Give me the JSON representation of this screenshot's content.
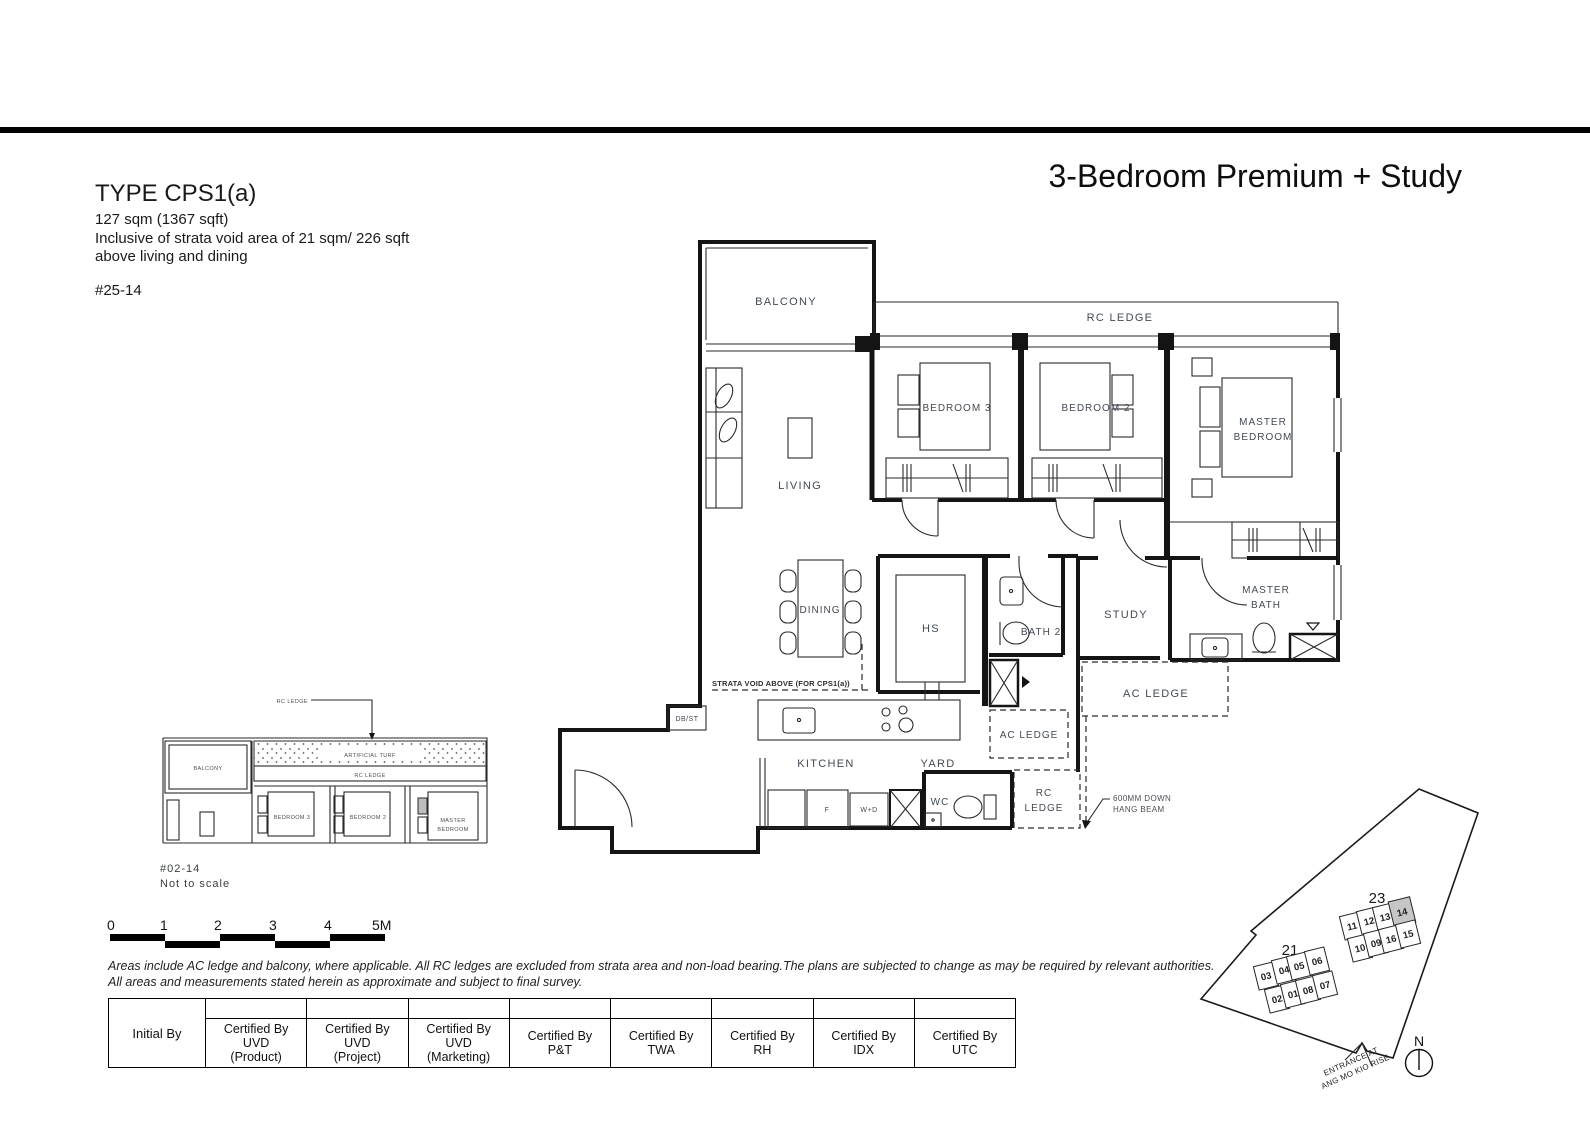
{
  "header": {
    "type_title": "TYPE CPS1(a)",
    "area": "127 sqm (1367 sqft)",
    "inclusive1": "Inclusive of strata void area of 21 sqm/ 226 sqft",
    "inclusive2": "above living and dining",
    "unit": "#25-14",
    "plan_name": "3-Bedroom Premium + Study"
  },
  "plan": {
    "balcony": "BALCONY",
    "living": "LIVING",
    "dining": "DINING",
    "bedroom3": "BEDROOM 3",
    "bedroom2": "BEDROOM 2",
    "master_bedroom_l1": "MASTER",
    "master_bedroom_l2": "BEDROOM",
    "rc_ledge_top": "RC LEDGE",
    "hs": "HS",
    "bath2": "BATH 2",
    "study": "STUDY",
    "master_bath_l1": "MASTER",
    "master_bath_l2": "BATH",
    "ac_ledge_right": "AC LEDGE",
    "ac_ledge_mid": "AC LEDGE",
    "kitchen": "KITCHEN",
    "yard": "YARD",
    "wc": "WC",
    "rc_ledge_bottom_l1": "RC",
    "rc_ledge_bottom_l2": "LEDGE",
    "db_st": "DB/ST",
    "strata_void": "STRATA VOID ABOVE (FOR CPS1(a))",
    "beam_l1": "600MM DOWN",
    "beam_l2": "HANG BEAM",
    "fridge": "F",
    "washer": "W+D"
  },
  "inset": {
    "rc_ledge_callout": "RC LEDGE",
    "artificial_turf": "ARTIFICIAL TURF",
    "rc_ledge": "RC LEDGE",
    "balcony": "BALCONY",
    "bedroom3": "BEDROOM 3",
    "bedroom2": "BEDROOM 2",
    "master_l1": "MASTER",
    "master_l2": "BEDROOM",
    "caption1": "#02-14",
    "caption2": "Not to scale"
  },
  "scalebar": {
    "ticks": [
      "0",
      "1",
      "2",
      "3",
      "4",
      "5M"
    ]
  },
  "disclaimer": {
    "line1": "Areas include AC ledge and balcony, where applicable. All RC ledges are excluded from strata area and non-load bearing.The plans are subjected to change as may be required by relevant authorities.",
    "line2": "All areas and measurements stated herein as approximate and subject to final survey."
  },
  "cert_table": {
    "initial_by": "Initial By",
    "columns": [
      {
        "l1": "Certified By",
        "l2": "UVD",
        "l3": "(Product)"
      },
      {
        "l1": "Certified By",
        "l2": "UVD",
        "l3": "(Project)"
      },
      {
        "l1": "Certified By",
        "l2": "UVD",
        "l3": "(Marketing)"
      },
      {
        "l1": "Certified By",
        "l2": "P&T"
      },
      {
        "l1": "Certified By",
        "l2": "TWA"
      },
      {
        "l1": "Certified By",
        "l2": "RH"
      },
      {
        "l1": "Certified By",
        "l2": "IDX"
      },
      {
        "l1": "Certified By",
        "l2": "UTC"
      }
    ]
  },
  "siteplan": {
    "block23_label": "23",
    "block21_label": "21",
    "units23_top": [
      "11",
      "12",
      "13",
      "14"
    ],
    "units23_bottom": [
      "10",
      "09",
      "16",
      "15"
    ],
    "units21_top": [
      "03",
      "04",
      "05",
      "06"
    ],
    "units21_bottom": [
      "02",
      "01",
      "08",
      "07"
    ],
    "highlight_unit": "14",
    "entrance_l1": "ENTRANCE AT",
    "entrance_l2": "ANG MO KIO RISE",
    "north": "N"
  },
  "colors": {
    "wall": "#141414",
    "label": "#434a52",
    "highlight": "#c6c6c6"
  }
}
